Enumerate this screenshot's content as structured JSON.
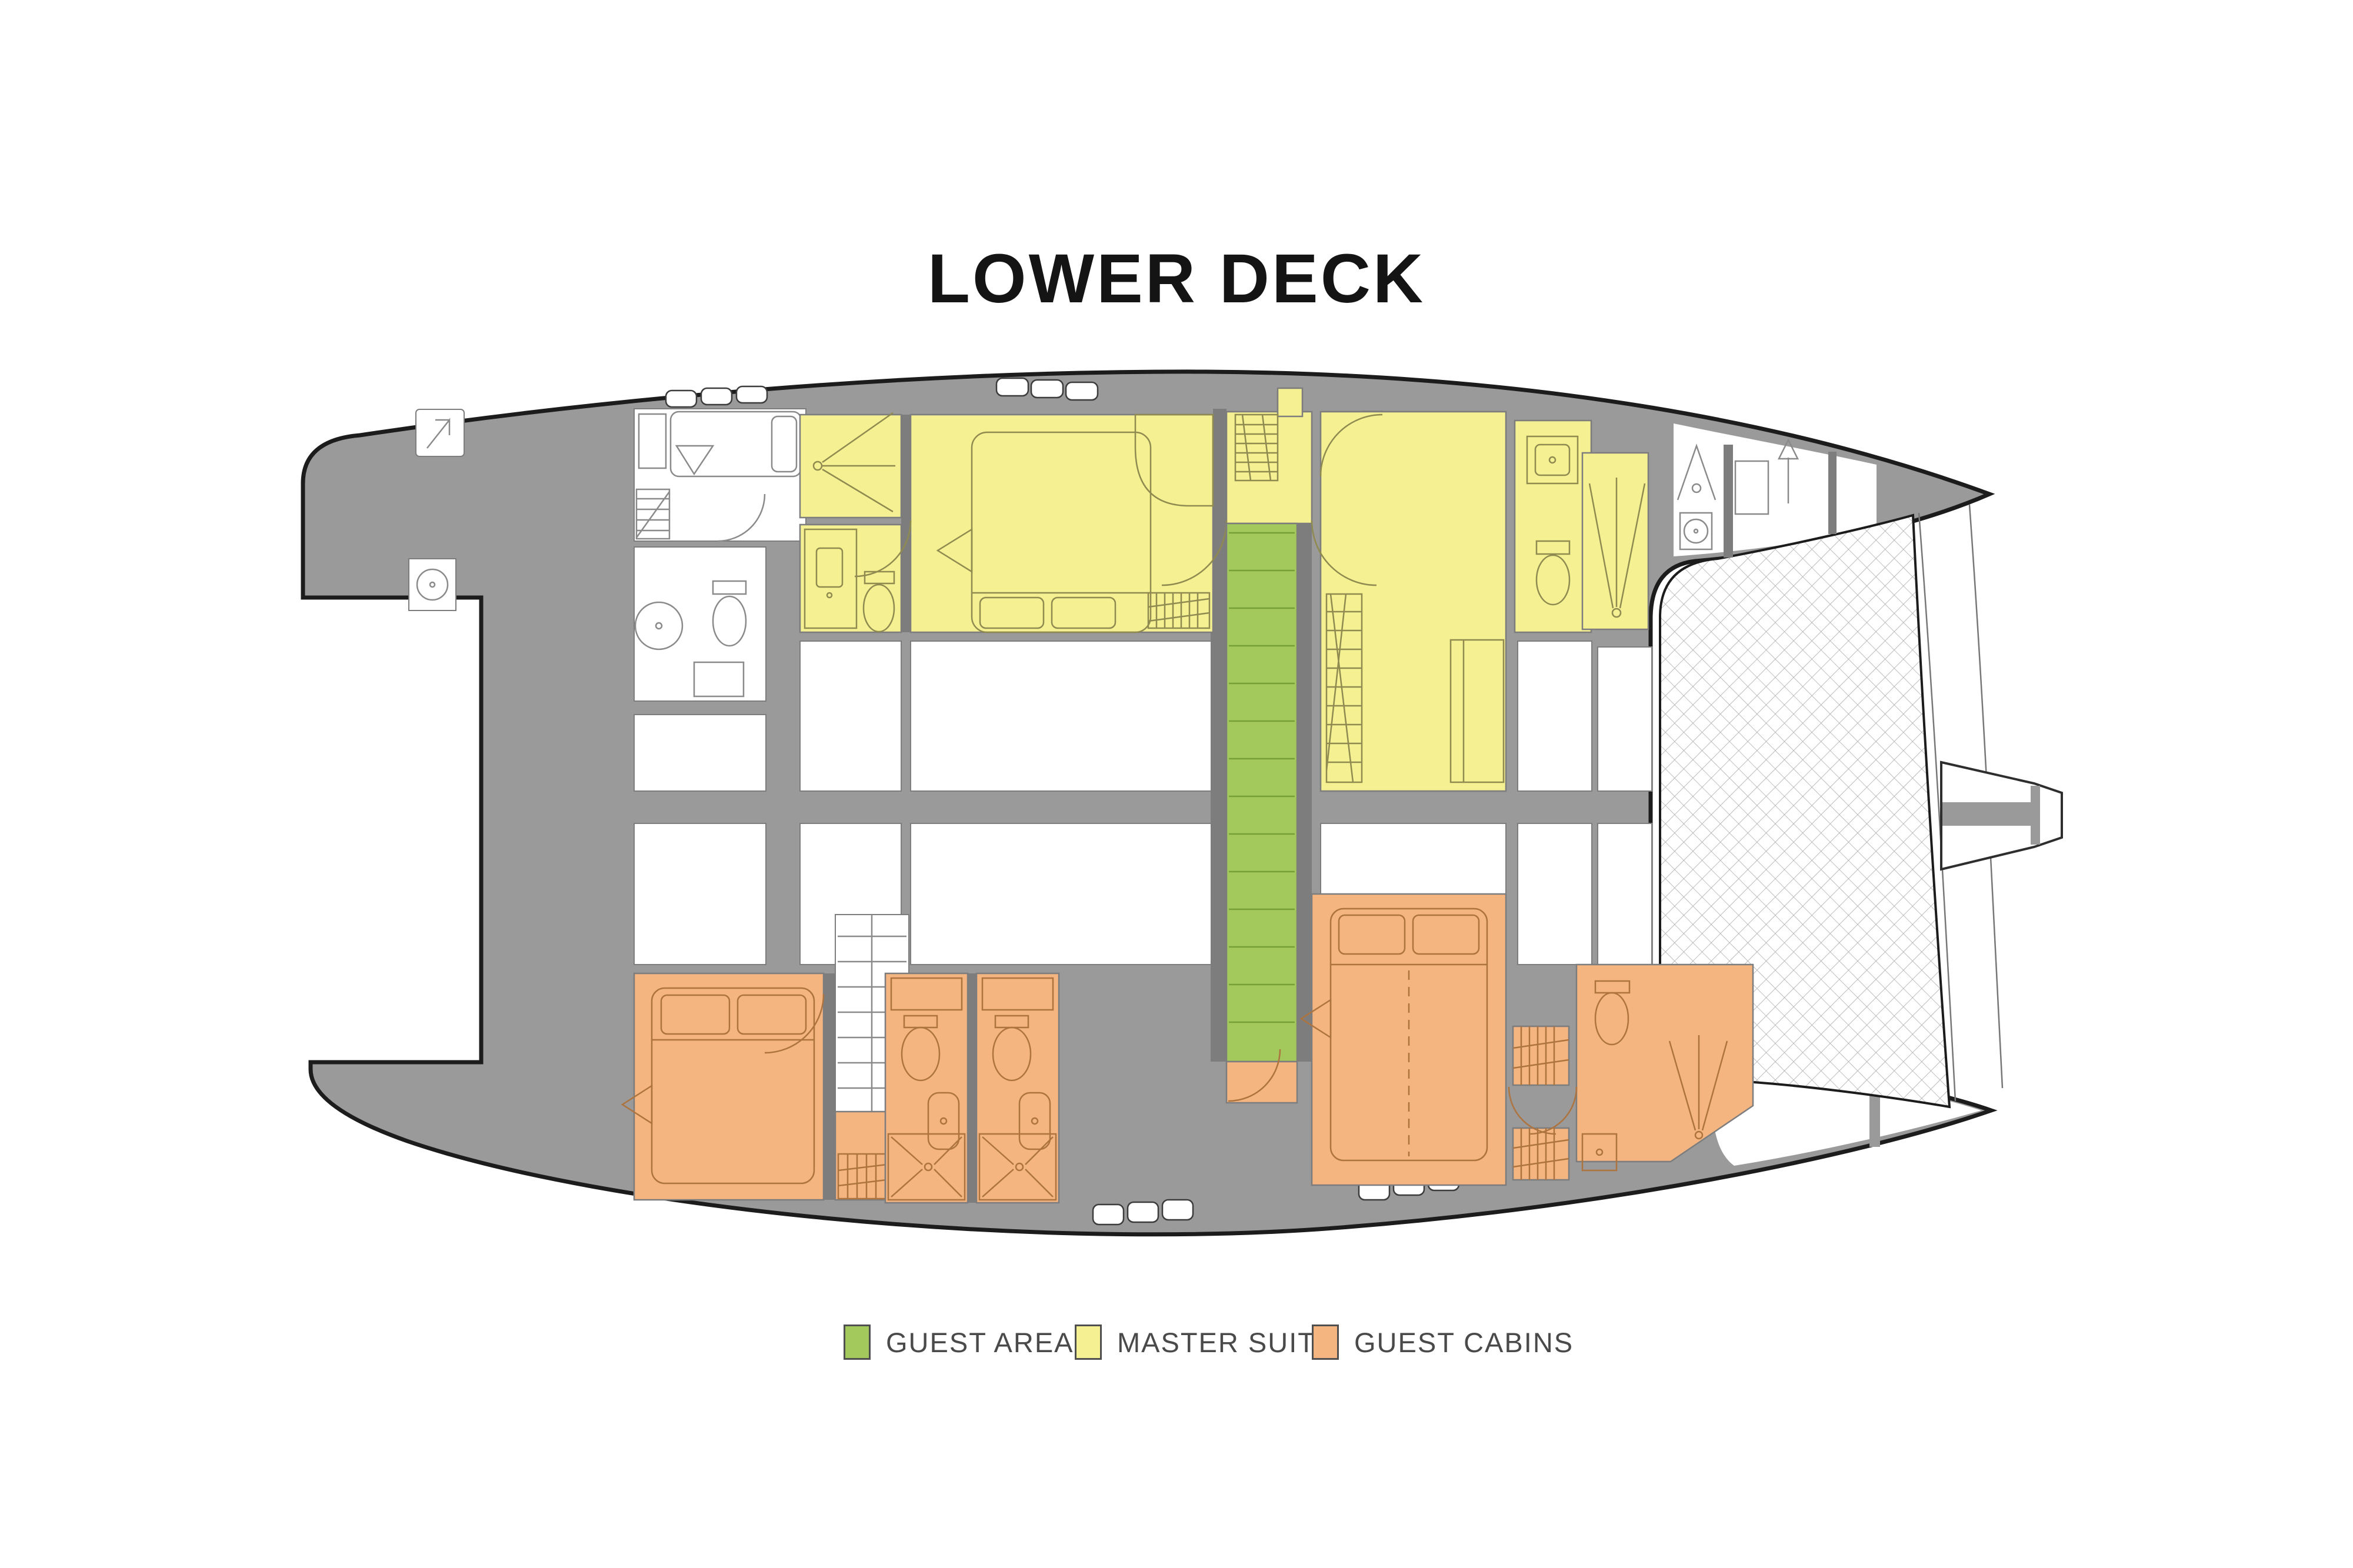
{
  "title": "LOWER DECK",
  "legend": {
    "items": [
      {
        "id": "guest-areas",
        "label": "GUEST AREAS",
        "color": "#a3c95c"
      },
      {
        "id": "master-suite",
        "label": "MASTER SUITE",
        "color": "#f5f091"
      },
      {
        "id": "guest-cabins",
        "label": "GUEST CABINS",
        "color": "#f4b581"
      }
    ]
  },
  "colors": {
    "hull": "#9a9a9a",
    "outline": "#1c1c1c",
    "wall": "#7d7d7d",
    "window_stroke": "#3c3c3c",
    "net_line": "#ababab",
    "furniture_master": "#8f8a50",
    "furniture_cabins": "#ad7440",
    "furniture_neutral": "#8a8a8a",
    "stair_tread": "#76a038",
    "title": "#141414",
    "legend_text": "#4a4a4a",
    "legend_swatch_border": "#4f4f4f"
  }
}
